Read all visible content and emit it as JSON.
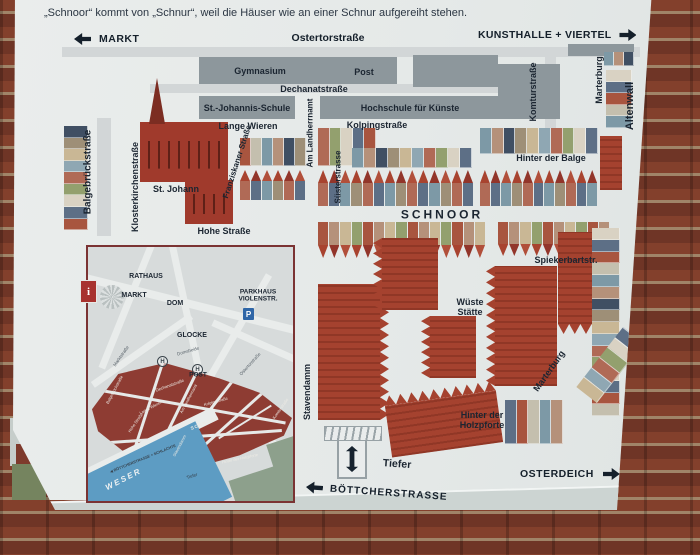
{
  "header": {
    "line1": "der Weser. Das Schnoorviertel",
    "line2": "„Schnoor“ kommt von „Schnur“, weil die Häuser wie an einer Schnur aufgereiht stehen."
  },
  "nav": {
    "left": "MARKT",
    "center": "Ostertorstraße",
    "right": "KUNSTHALLE + VIERTEL"
  },
  "bottom": {
    "osterdeich": "OSTERDEICH",
    "boettcher": "BÖTTCHERSTRASSE"
  },
  "icons": {
    "info": "i",
    "parking": "P",
    "tram_stop": "H"
  },
  "colors": {
    "sign_bg": "#e8ebea",
    "building_gray": "#8d979c",
    "roof_red": "#a5422f",
    "district_red": "#8e3c33",
    "weser_blue": "#5d9cc3",
    "text_dark": "#1b2531",
    "brick": "#83402c"
  },
  "map": {
    "labels": [
      {
        "t": "Gymnasium",
        "x": 260,
        "y": 71,
        "s": 9
      },
      {
        "t": "Post",
        "x": 364,
        "y": 72,
        "s": 9
      },
      {
        "t": "Dechanatstraße",
        "x": 314,
        "y": 89,
        "s": 9
      },
      {
        "t": "St.-Johannis-Schule",
        "x": 247,
        "y": 108,
        "s": 9
      },
      {
        "t": "Hochschule für Künste",
        "x": 410,
        "y": 108,
        "s": 9
      },
      {
        "t": "Komturstraße",
        "x": 533,
        "y": 92,
        "r": -90,
        "s": 9
      },
      {
        "t": "Marterburg",
        "x": 599,
        "y": 80,
        "r": -90,
        "s": 9
      },
      {
        "t": "Altenwall",
        "x": 630,
        "y": 106,
        "r": -90,
        "s": 11
      },
      {
        "t": "Lange Wieren",
        "x": 248,
        "y": 126,
        "s": 9
      },
      {
        "t": "Kolpingstraße",
        "x": 377,
        "y": 125,
        "s": 9
      },
      {
        "t": "Am Landherrnamt",
        "x": 311,
        "y": 133,
        "r": -90,
        "s": 8
      },
      {
        "t": "Süsterstrasse",
        "x": 339,
        "y": 177,
        "r": -90,
        "s": 8
      },
      {
        "t": "Hinter der Balge",
        "x": 551,
        "y": 158,
        "s": 9
      },
      {
        "t": "Balgebrückstraße",
        "x": 88,
        "y": 172,
        "r": -90,
        "s": 10
      },
      {
        "t": "Klosterkirchenstraße",
        "x": 135,
        "y": 187,
        "r": -90,
        "s": 9
      },
      {
        "t": "Franziskaner Straße",
        "x": 238,
        "y": 162,
        "r": -72,
        "s": 8
      },
      {
        "t": "St. Johann",
        "x": 176,
        "y": 189,
        "s": 9
      },
      {
        "t": "Hohe Straße",
        "x": 224,
        "y": 231,
        "s": 9
      },
      {
        "t": "SCHNOOR",
        "x": 442,
        "y": 215,
        "s": 12,
        "ls": 3
      },
      {
        "t": "Spiekerbartstr.",
        "x": 566,
        "y": 260,
        "s": 9
      },
      {
        "t": "Wüste\nStätte",
        "x": 470,
        "y": 307,
        "s": 9
      },
      {
        "t": "Stavendamm",
        "x": 307,
        "y": 392,
        "r": -90,
        "s": 9
      },
      {
        "t": "Marterburg",
        "x": 549,
        "y": 371,
        "r": -55,
        "s": 9
      },
      {
        "t": "Hinter der\nHolzpforte",
        "x": 482,
        "y": 420,
        "s": 9
      },
      {
        "t": "Tiefer",
        "x": 397,
        "y": 465,
        "r": 4,
        "s": 10.5
      }
    ],
    "blocks": [
      {
        "x": 62,
        "y": 47,
        "w": 578,
        "h": 10,
        "t": "street"
      },
      {
        "x": 150,
        "y": 84,
        "w": 356,
        "h": 9,
        "t": "street"
      },
      {
        "x": 97,
        "y": 118,
        "w": 14,
        "h": 118,
        "t": "street"
      },
      {
        "x": 545,
        "y": 54,
        "w": 11,
        "h": 92,
        "t": "street"
      },
      {
        "x": 568,
        "y": 44,
        "w": 66,
        "h": 12,
        "t": "gray"
      },
      {
        "x": 199,
        "y": 57,
        "w": 198,
        "h": 27,
        "t": "gray"
      },
      {
        "x": 413,
        "y": 55,
        "w": 85,
        "h": 32,
        "t": "gray"
      },
      {
        "x": 199,
        "y": 96,
        "w": 96,
        "h": 23,
        "t": "gray"
      },
      {
        "x": 320,
        "y": 96,
        "w": 178,
        "h": 23,
        "t": "gray"
      },
      {
        "x": 498,
        "y": 64,
        "w": 62,
        "h": 55,
        "t": "gray"
      },
      {
        "x": 64,
        "y": 126,
        "w": 24,
        "h": 104,
        "t": "flats",
        "v": 1
      },
      {
        "x": 140,
        "y": 122,
        "w": 88,
        "h": 60,
        "t": "church"
      },
      {
        "x": 149,
        "y": 78,
        "w": 16,
        "h": 46,
        "t": "spire"
      },
      {
        "x": 185,
        "y": 180,
        "w": 48,
        "h": 44,
        "t": "church"
      },
      {
        "x": 240,
        "y": 138,
        "w": 66,
        "h": 28,
        "t": "flats"
      },
      {
        "x": 240,
        "y": 170,
        "w": 66,
        "h": 30,
        "t": "houses"
      },
      {
        "x": 318,
        "y": 128,
        "w": 58,
        "h": 38,
        "t": "flats"
      },
      {
        "x": 352,
        "y": 148,
        "w": 120,
        "h": 20,
        "t": "flats"
      },
      {
        "x": 318,
        "y": 170,
        "w": 156,
        "h": 36,
        "t": "houses"
      },
      {
        "x": 480,
        "y": 128,
        "w": 118,
        "h": 26,
        "t": "flats"
      },
      {
        "x": 480,
        "y": 170,
        "w": 118,
        "h": 36,
        "t": "houses"
      },
      {
        "x": 600,
        "y": 136,
        "w": 22,
        "h": 54,
        "t": "red"
      },
      {
        "x": 604,
        "y": 52,
        "w": 30,
        "h": 14,
        "t": "flats"
      },
      {
        "x": 606,
        "y": 70,
        "w": 26,
        "h": 58,
        "t": "flats",
        "v": 1
      },
      {
        "x": 318,
        "y": 222,
        "w": 168,
        "h": 36,
        "t": "houses",
        "f": 1
      },
      {
        "x": 498,
        "y": 222,
        "w": 112,
        "h": 34,
        "t": "houses",
        "f": 1
      },
      {
        "x": 318,
        "y": 284,
        "w": 62,
        "h": 136,
        "t": "red",
        "zz": "right"
      },
      {
        "x": 382,
        "y": 238,
        "w": 56,
        "h": 72,
        "t": "red",
        "zz": "left"
      },
      {
        "x": 430,
        "y": 316,
        "w": 46,
        "h": 62,
        "t": "red",
        "zz": "left"
      },
      {
        "x": 495,
        "y": 266,
        "w": 62,
        "h": 120,
        "t": "red",
        "zz": "left"
      },
      {
        "x": 558,
        "y": 232,
        "w": 56,
        "h": 92,
        "t": "red",
        "zz": "bottom"
      },
      {
        "x": 592,
        "y": 228,
        "w": 28,
        "h": 188,
        "t": "flats",
        "v": 1
      },
      {
        "x": 388,
        "y": 398,
        "w": 112,
        "h": 52,
        "t": "red",
        "r": -8,
        "zz": "top"
      },
      {
        "x": 505,
        "y": 400,
        "w": 58,
        "h": 44,
        "t": "flats"
      },
      {
        "x": 572,
        "y": 352,
        "w": 76,
        "h": 26,
        "t": "flats",
        "r": -52
      }
    ]
  },
  "inset": {
    "labels": [
      {
        "t": "RATHAUS",
        "x": 58,
        "y": 30,
        "s": 7
      },
      {
        "t": "MARKT",
        "x": 46,
        "y": 49,
        "s": 7
      },
      {
        "t": "DOM",
        "x": 87,
        "y": 57,
        "s": 7
      },
      {
        "t": "PARKHAUS\nVIOLENSTR.",
        "x": 170,
        "y": 49,
        "s": 6.5
      },
      {
        "t": "GLOCKE",
        "x": 104,
        "y": 89,
        "s": 7
      },
      {
        "t": "POST",
        "x": 110,
        "y": 128,
        "s": 6.5
      },
      {
        "t": "Marktstraße",
        "x": 33,
        "y": 109,
        "r": -55,
        "s": 4.5,
        "w": 400,
        "c": "#566068"
      },
      {
        "t": "Domsheide",
        "x": 100,
        "y": 104,
        "r": -16,
        "s": 4.5,
        "w": 400,
        "c": "#566068"
      },
      {
        "t": "Ostertorstraße",
        "x": 162,
        "y": 117,
        "r": -48,
        "s": 4.5,
        "w": 400,
        "c": "#566068"
      },
      {
        "t": "Dechanatstraße",
        "x": 82,
        "y": 139,
        "r": -20,
        "s": 4.2,
        "w": 400,
        "c": "#eceae4"
      },
      {
        "t": "Balgebrückstraße",
        "x": 27,
        "y": 143,
        "r": -62,
        "s": 4,
        "w": 400,
        "c": "#eceae4"
      },
      {
        "t": "Lange Wieren",
        "x": 63,
        "y": 161,
        "r": -28,
        "s": 4,
        "w": 400,
        "c": "#eceae4"
      },
      {
        "t": "Hohe Straße",
        "x": 48,
        "y": 176,
        "r": -55,
        "s": 4,
        "w": 400,
        "c": "#eceae4"
      },
      {
        "t": "Am Landherrnamt",
        "x": 101,
        "y": 152,
        "r": -62,
        "s": 4,
        "w": 400,
        "c": "#eceae4"
      },
      {
        "t": "Kolpingstraße",
        "x": 128,
        "y": 155,
        "r": -16,
        "s": 4,
        "w": 400,
        "c": "#eceae4"
      },
      {
        "t": "SCHNOOR",
        "x": 117,
        "y": 176,
        "r": -22,
        "s": 4.6,
        "ls": 1,
        "c": "#eceae4"
      },
      {
        "t": "Stavendamm",
        "x": 92,
        "y": 199,
        "r": -62,
        "s": 4,
        "w": 400,
        "c": "#eceae4"
      },
      {
        "t": "Hinter der Holzpforte",
        "x": 152,
        "y": 212,
        "r": -12,
        "s": 4,
        "w": 400,
        "c": "#eceae4"
      },
      {
        "t": "Komturstraße",
        "x": 193,
        "y": 162,
        "r": -55,
        "s": 4,
        "w": 400,
        "c": "#eceae4"
      },
      {
        "t": "Marterburg",
        "x": 213,
        "y": 177,
        "r": -55,
        "s": 4,
        "w": 400,
        "c": "#eceae4"
      },
      {
        "t": "Tiefer",
        "x": 104,
        "y": 229,
        "r": -18,
        "s": 4.5,
        "w": 400,
        "c": "#37434e"
      },
      {
        "t": "◀ BÖTTCHERSTRASSE + SCHLACHTE",
        "x": 55,
        "y": 212,
        "r": -22,
        "s": 3.8,
        "c": "#37434e"
      },
      {
        "t": "WESER",
        "x": 36,
        "y": 233,
        "r": -27,
        "s": 8,
        "ls": 2,
        "c": "#edf1f2",
        "i": 1
      }
    ]
  }
}
